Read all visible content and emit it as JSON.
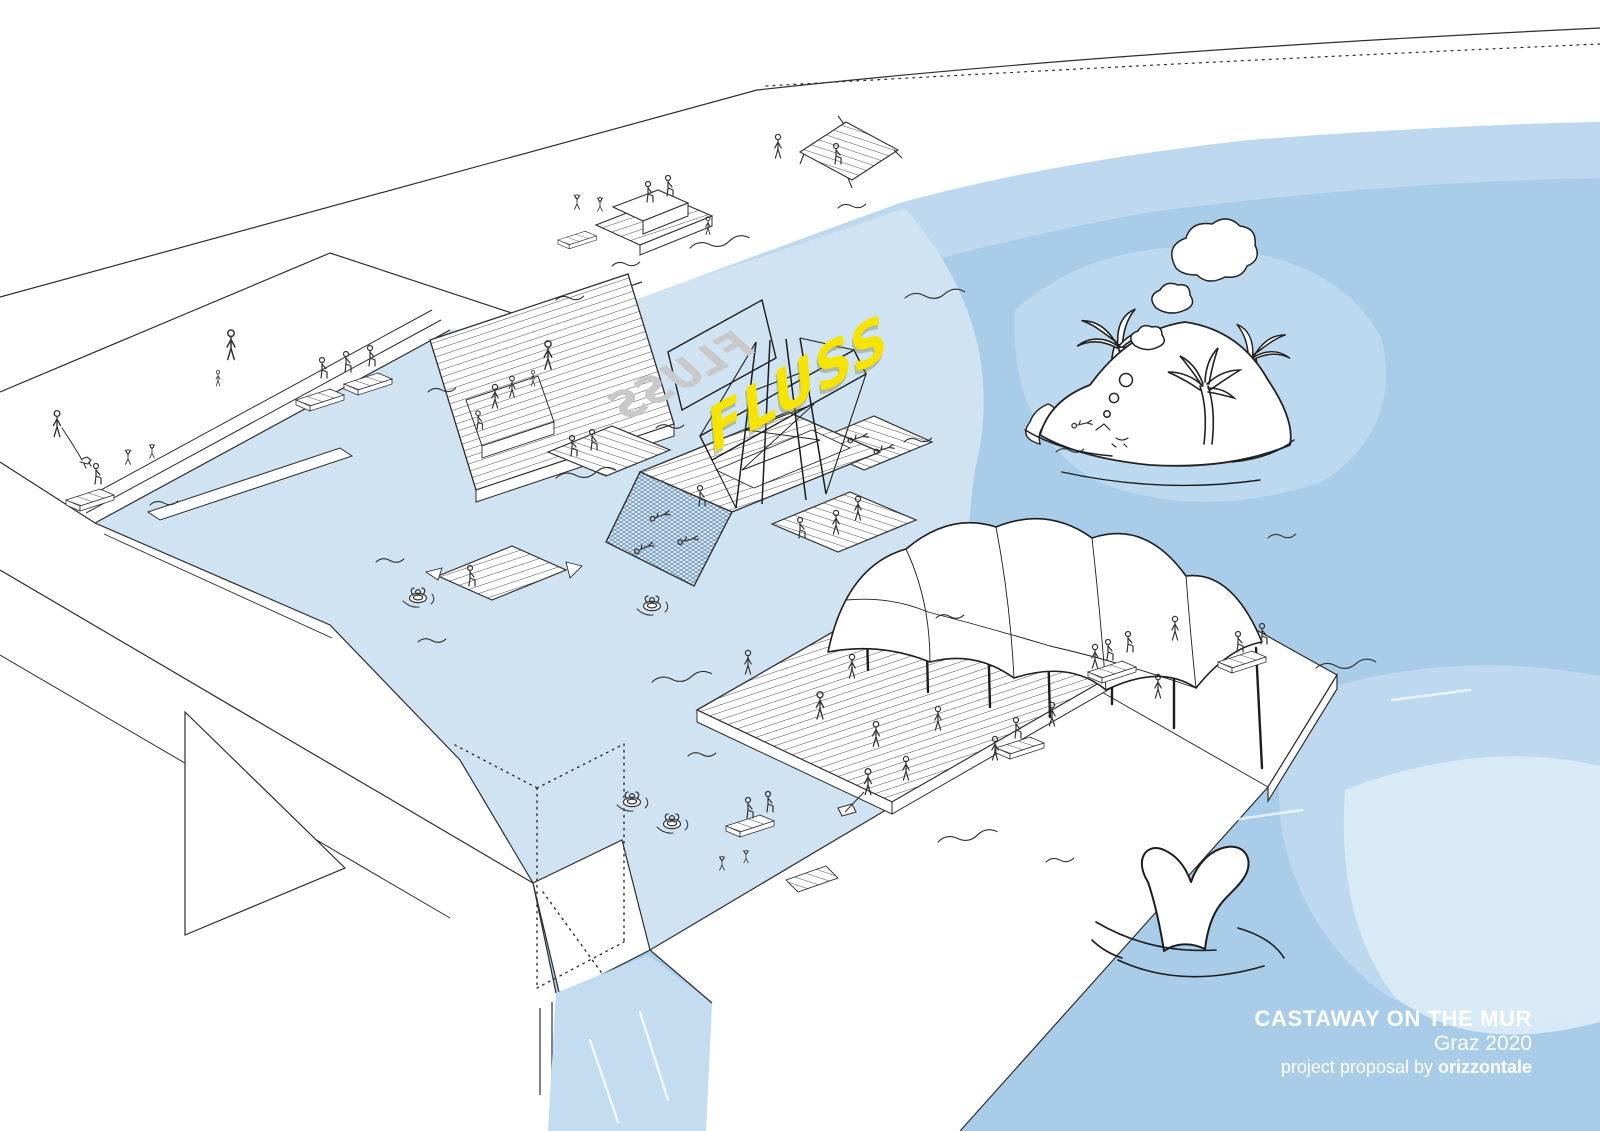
{
  "title_block": {
    "line1": "CASTAWAY ON THE MUR",
    "line2": "Graz 2020",
    "line3_prefix": "project proposal by ",
    "line3_brand": "orizzontale"
  },
  "sign": {
    "front_text": "FLUSS",
    "back_text": "FLUSS",
    "front_color": "#f5e400",
    "back_color": "#c9c9c9"
  },
  "palette": {
    "water_main": "#a9cde9",
    "water_mid": "#c0daf0",
    "water_light": "#cfe3f2",
    "water_pale": "#dcebf7",
    "water_channel": "#c3dcf0",
    "line": "#2e2e2e",
    "land": "#ffffff",
    "title_text": "#ffffff"
  },
  "scene_elements": [
    "river-water",
    "swimming-lagoon",
    "flood-bridge",
    "boardwalk-pier",
    "event-deck",
    "tent-canopy",
    "fluss-sign-tower",
    "net-swimming-platform",
    "floating-rafts",
    "palm-island",
    "dream-clouds",
    "whale-tail",
    "tube-swimmers",
    "promenade-benches",
    "tiered-seating",
    "stick-figure-people"
  ]
}
